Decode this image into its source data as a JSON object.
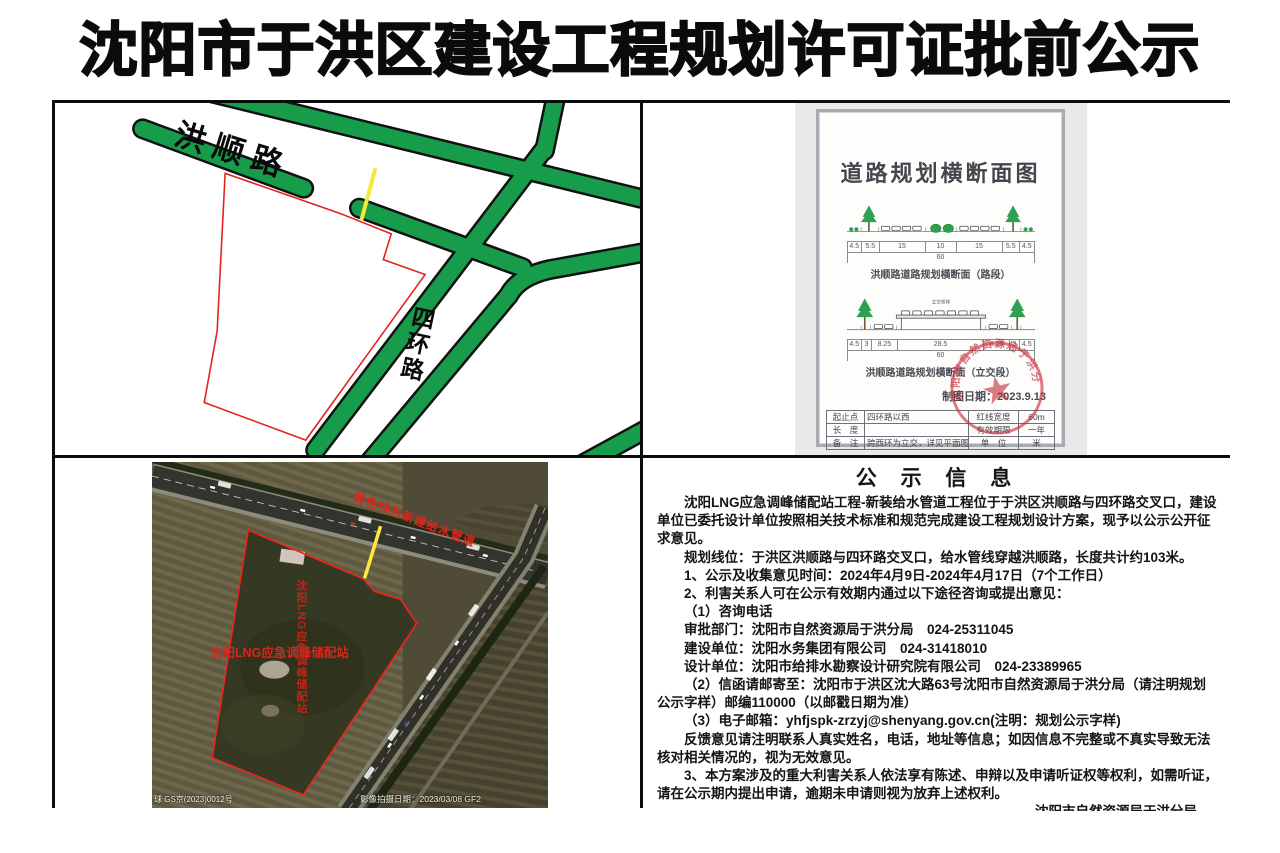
{
  "page": {
    "title": "沈阳市于洪区建设工程规划许可证批前公示"
  },
  "map": {
    "road_hongshun": "洪顺路",
    "road_sihuan": "四环路",
    "annotation": "黄色线为新建给水管道",
    "site_label": "沈阳LNG应急调峰储配站",
    "colors": {
      "road_green": "#179c4b",
      "annotation_red": "#e53026",
      "pipe_yellow": "#f1ea39",
      "boundary_red": "#e2241c"
    }
  },
  "doc": {
    "title": "道路规划横断面图",
    "sections": [
      {
        "caption": "洪顺路道路规划横断面（路段）",
        "dims": [
          "4.5",
          "5.5",
          "15",
          "10",
          "15",
          "5.5",
          "4.5"
        ],
        "total": "60"
      },
      {
        "caption": "洪顺路道路规划横断面（立交段）",
        "dims": [
          "4.5",
          "3",
          "8.25",
          "28.5",
          "8.25",
          "3",
          "4.5"
        ],
        "total": "60",
        "deck_label": "立交桥体"
      }
    ],
    "date_line": "制图日期：2023.9.13",
    "table": {
      "rows": [
        {
          "k1": "起止点",
          "v1": "四环路以西",
          "k2": "红线宽度",
          "v2": "60m"
        },
        {
          "k1": "长　度",
          "v1": "",
          "k2": "有效期限",
          "v2": "一年"
        },
        {
          "k1": "备　注",
          "v1": "跨西环为立交，详见平面图",
          "k2": "单　位",
          "v2": "米"
        }
      ]
    },
    "stamp_text": "沈阳市自然资源局于洪分局"
  },
  "satellite": {
    "annotation": "黄色线为新建给水管道",
    "site_label": "沈阳LNG应急调峰储配站",
    "site_label_vertical": "沈阳LNG应急调峰储配站",
    "attribution_left": "球 GS京(2023)0012号",
    "attribution_right": "影像拍摄日期：2023/03/08 GF2"
  },
  "notice": {
    "title": "公 示 信 息",
    "paragraphs": [
      "沈阳LNG应急调峰储配站工程-新装给水管道工程位于于洪区洪顺路与四环路交叉口，建设单位已委托设计单位按照相关技术标准和规范完成建设工程规划设计方案，现予以公示公开征求意见。",
      "规划线位：于洪区洪顺路与四环路交叉口，给水管线穿越洪顺路，长度共计约103米。",
      "1、公示及收集意见时间：2024年4月9日-2024年4月17日（7个工作日）",
      "2、利害关系人可在公示有效期内通过以下途径咨询或提出意见：",
      "（1）咨询电话",
      "审批部门：沈阳市自然资源局于洪分局　024-25311045",
      "建设单位：沈阳水务集团有限公司　024-31418010",
      "设计单位：沈阳市给排水勘察设计研究院有限公司　024-23389965",
      "（2）信函请邮寄至：沈阳市于洪区沈大路63号沈阳市自然资源局于洪分局（请注明规划公示字样）邮编110000（以邮戳日期为准）",
      "（3）电子邮箱：yhfjspk-zrzyj@shenyang.gov.cn(注明：规划公示字样)",
      "反馈意见请注明联系人真实姓名，电话，地址等信息；如因信息不完整或不真实导致无法核对相关情况的，视为无效意见。",
      "3、本方案涉及的重大利害关系人依法享有陈述、申辩以及申请听证权等权利，如需听证，请在公示期内提出申请，逾期未申请则视为放弃上述权利。"
    ],
    "signature": "沈阳市自然资源局于洪分局",
    "date": "2024年4月9日"
  }
}
